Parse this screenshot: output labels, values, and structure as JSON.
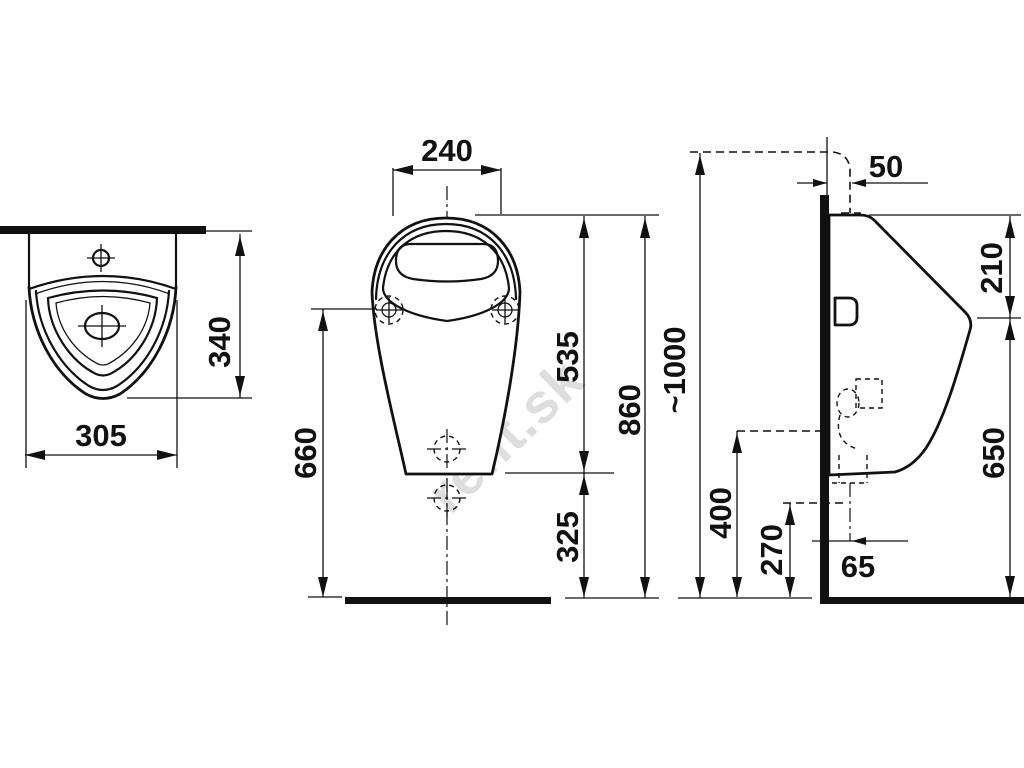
{
  "drawing": {
    "title": "urinal-installation-dimensions",
    "background_color": "#ffffff",
    "line_color": "#111111",
    "watermark": {
      "text": "rent.sk",
      "color": "rgba(0,0,0,0.13)"
    },
    "dimensions": {
      "top_view": {
        "width": "305",
        "depth": "340"
      },
      "front_view": {
        "rim_width": "240",
        "mount_holes_to_floor": "660",
        "rim_to_body_bottom": "535",
        "body_bottom_to_floor": "325",
        "rim_to_floor": "860",
        "water_supply_to_floor": "~1000"
      },
      "side_view": {
        "supply_offset_from_wall": "50",
        "top_to_front_edge": "210",
        "front_edge_to_floor": "650",
        "trap_level": "400",
        "outlet_level": "270",
        "outlet_offset_from_wall": "65"
      }
    }
  }
}
